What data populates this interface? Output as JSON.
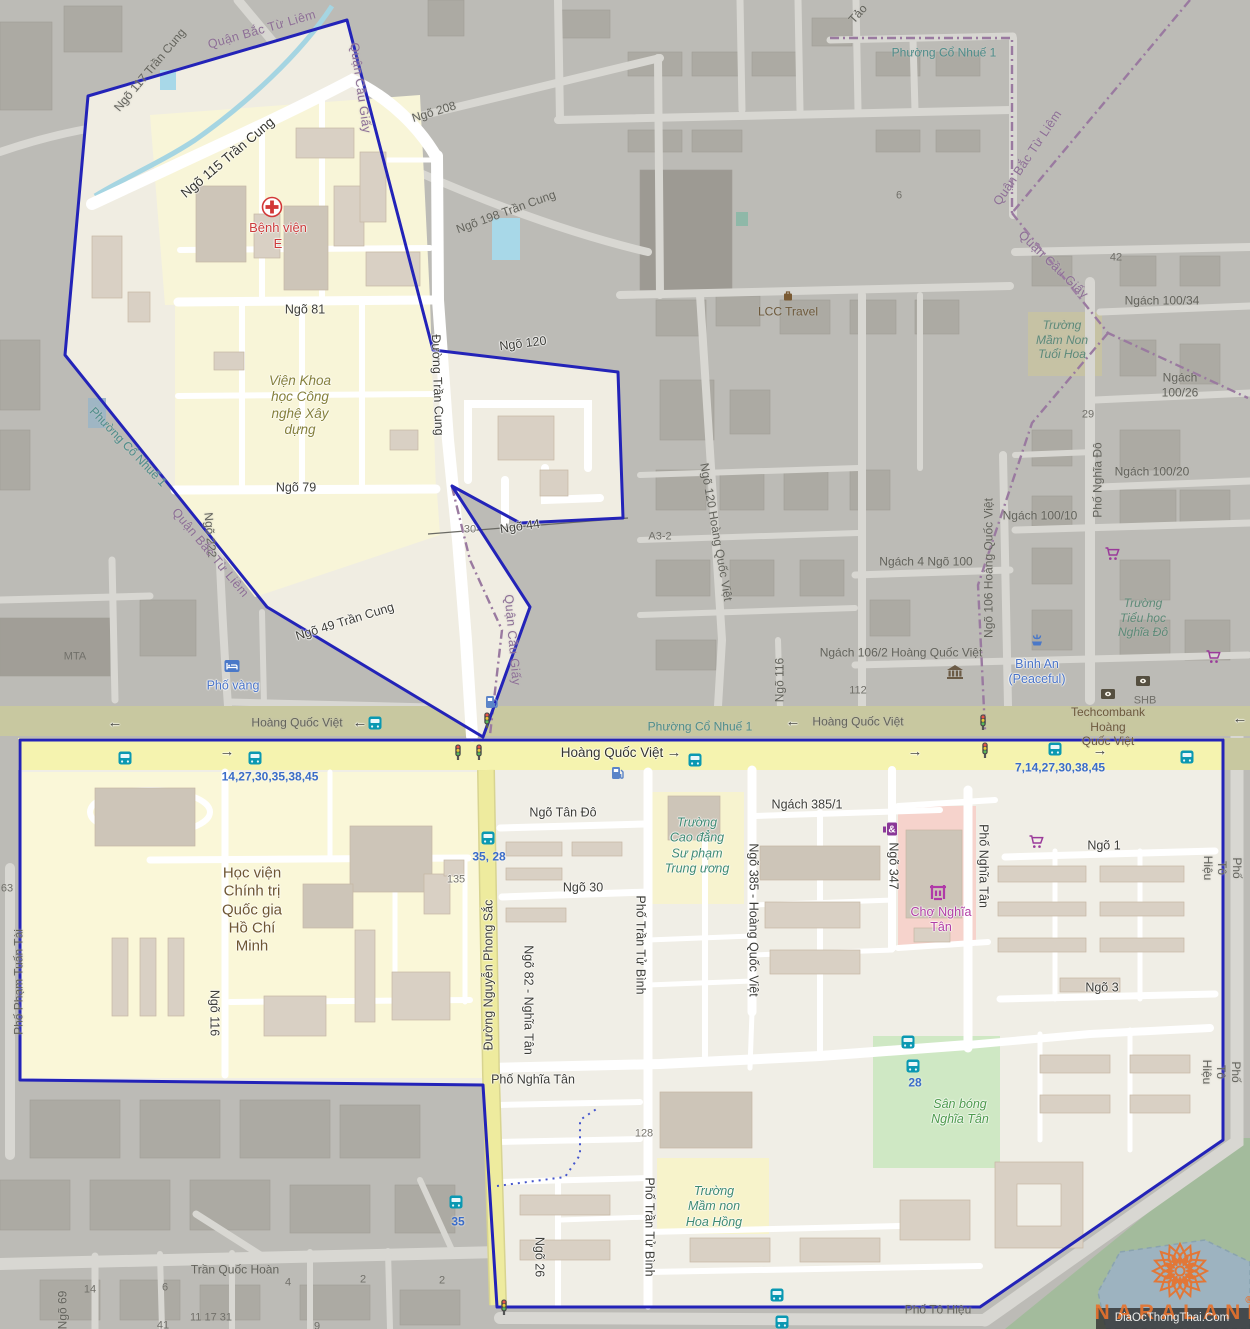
{
  "page": {
    "width": 1250,
    "height": 1329
  },
  "watermark": {
    "brand": "NARALAND",
    "reg": "®",
    "attribution": "DiaOcThongThai.Com"
  },
  "colors": {
    "boundary": "#2323b8",
    "admin_boundary": "#9a7aa0",
    "residential": "#faf7d8",
    "main_road": "#f5f3af",
    "dim_base": "#bcbbb6",
    "bus_badge": "#0a98b2",
    "route_text": "#3a6cc8",
    "watermark_orange": "#e8722c"
  },
  "labels": [
    {
      "id": "ngo-117",
      "text": "Ngõ 117 Trần Cung",
      "x": 150,
      "y": 70,
      "rot": -50,
      "cls": "rd-dim"
    },
    {
      "id": "quan-bac-tu-liem-top",
      "text": "Quận Bắc Từ Liêm",
      "x": 262,
      "y": 30,
      "rot": -16,
      "cls": "adm"
    },
    {
      "id": "quan-cau-giay-top",
      "text": "Quận Cầu Giấy",
      "x": 360,
      "y": 88,
      "rot": 82,
      "cls": "adm"
    },
    {
      "id": "ngo-115-tran-cung",
      "text": "Ngõ 115 Trần Cung",
      "x": 228,
      "y": 158,
      "rot": -40,
      "cls": "rd-big"
    },
    {
      "id": "benh-vien-e",
      "text": "Bệnh viện\nE",
      "x": 278,
      "y": 236,
      "rot": 0,
      "cls": "red"
    },
    {
      "id": "ngo-208",
      "text": "Ngõ 208",
      "x": 434,
      "y": 112,
      "rot": -17,
      "cls": "rd-dim"
    },
    {
      "id": "ngo-198-tran-cung",
      "text": "Ngõ 198 Trần Cung",
      "x": 506,
      "y": 212,
      "rot": -20,
      "cls": "rd-dim"
    },
    {
      "id": "phuong-co-nhue-1-top",
      "text": "Phường Cổ Nhuế 1",
      "x": 944,
      "y": 53,
      "rot": 0,
      "cls": "plc"
    },
    {
      "id": "tao",
      "text": "Tảo",
      "x": 858,
      "y": 14,
      "rot": -48,
      "cls": "rd-dim"
    },
    {
      "id": "quan-bac-tu-liem-right",
      "text": "Quận Bắc Từ Liêm",
      "x": 1028,
      "y": 158,
      "rot": -56,
      "cls": "adm"
    },
    {
      "id": "quan-cau-giay-right",
      "text": "Quận Cầu Giấy",
      "x": 1053,
      "y": 265,
      "rot": 44,
      "cls": "adm"
    },
    {
      "id": "num-6",
      "text": "6",
      "x": 899,
      "y": 196,
      "rot": 0,
      "cls": "num-dim"
    },
    {
      "id": "num-42",
      "text": "42",
      "x": 1116,
      "y": 258,
      "rot": 0,
      "cls": "num-dim"
    },
    {
      "id": "ngach-100-34",
      "text": "Ngách 100/34",
      "x": 1162,
      "y": 301,
      "rot": 0,
      "cls": "rd-dim"
    },
    {
      "id": "truong-mam-non-tuoi-hoa",
      "text": "Trường\nMầm Non\nTuổi Hoa",
      "x": 1062,
      "y": 340,
      "rot": 0,
      "cls": "sch-dim"
    },
    {
      "id": "ngach-100-26",
      "text": "Ngách 100/26",
      "x": 1180,
      "y": 385,
      "rot": 0,
      "cls": "rd-dim"
    },
    {
      "id": "num-29",
      "text": "29",
      "x": 1088,
      "y": 415,
      "rot": 0,
      "cls": "num-dim"
    },
    {
      "id": "pho-nghia-do",
      "text": "Phố Nghĩa Đô",
      "x": 1098,
      "y": 480,
      "rot": -90,
      "cls": "rd-dim"
    },
    {
      "id": "ngach-100-20",
      "text": "Ngách 100/20",
      "x": 1152,
      "y": 472,
      "rot": 0,
      "cls": "rd-dim"
    },
    {
      "id": "ngach-100-10",
      "text": "Ngách 100/10",
      "x": 1040,
      "y": 516,
      "rot": 0,
      "cls": "rd-dim"
    },
    {
      "id": "ngach-4-ngo-100",
      "text": "Ngách 4 Ngõ 100",
      "x": 926,
      "y": 562,
      "rot": 0,
      "cls": "rd-dim"
    },
    {
      "id": "ngo-106-hqv",
      "text": "Ngõ 106 Hoàng Quốc Việt",
      "x": 989,
      "y": 568,
      "rot": -90,
      "cls": "rd-dim"
    },
    {
      "id": "truong-tieu-hoc-nghia-do",
      "text": "Trường\nTiểu học\nNghĩa Đô",
      "x": 1143,
      "y": 618,
      "rot": 0,
      "cls": "sch-dim"
    },
    {
      "id": "lcc-travel",
      "text": "LCC Travel",
      "x": 788,
      "y": 312,
      "rot": 0,
      "cls": "brown-dim"
    },
    {
      "id": "ngo-120",
      "text": "Ngõ 120",
      "x": 523,
      "y": 344,
      "rot": -7,
      "cls": "rd"
    },
    {
      "id": "ngo-81",
      "text": "Ngõ 81",
      "x": 305,
      "y": 310,
      "rot": 0,
      "cls": "rd"
    },
    {
      "id": "vien-khoa-hoc",
      "text": "Viện Khoa\nhọc Công\nnghệ Xây\ndựng",
      "x": 300,
      "y": 406,
      "rot": 0,
      "cls": "olive"
    },
    {
      "id": "ngo-79",
      "text": "Ngõ 79",
      "x": 296,
      "y": 488,
      "rot": 0,
      "cls": "rd"
    },
    {
      "id": "duong-tran-cung",
      "text": "Đường Trần Cung",
      "x": 437,
      "y": 385,
      "rot": 88,
      "cls": "rd"
    },
    {
      "id": "a3-2",
      "text": "A3-2",
      "x": 660,
      "y": 537,
      "rot": 0,
      "cls": "num-dim"
    },
    {
      "id": "ngo-120-hqv",
      "text": "Ngõ 120 Hoàng Quốc Việt",
      "x": 716,
      "y": 532,
      "rot": 80,
      "cls": "rd-dim"
    },
    {
      "id": "ngo-44",
      "text": "Ngõ 44",
      "x": 520,
      "y": 527,
      "rot": -8,
      "cls": "rd"
    },
    {
      "id": "num-30-track",
      "text": "30",
      "x": 470,
      "y": 530,
      "rot": 0,
      "cls": "num"
    },
    {
      "id": "ngach-106-2",
      "text": "Ngách 106/2 Hoàng Quốc Việt",
      "x": 901,
      "y": 653,
      "rot": 0,
      "cls": "rd-dim"
    },
    {
      "id": "num-112",
      "text": "112",
      "x": 858,
      "y": 691,
      "rot": 0,
      "cls": "num-dim"
    },
    {
      "id": "ngo-116-dim",
      "text": "Ngõ 116",
      "x": 780,
      "y": 680,
      "rot": -90,
      "cls": "rd-dim"
    },
    {
      "id": "binh-an",
      "text": "Bình An\n(Peaceful)",
      "x": 1037,
      "y": 672,
      "rot": 0,
      "cls": "blue"
    },
    {
      "id": "shb",
      "text": "SHB",
      "x": 1145,
      "y": 701,
      "rot": 0,
      "cls": "num-dim"
    },
    {
      "id": "techcombank",
      "text": "Techcombank\nHoàng\nQuốc Việt",
      "x": 1108,
      "y": 727,
      "rot": 0,
      "cls": "brown-dim"
    },
    {
      "id": "mta",
      "text": "MTA",
      "x": 75,
      "y": 657,
      "rot": 0,
      "cls": "num-dim"
    },
    {
      "id": "ngo-222",
      "text": "Ngõ 222",
      "x": 210,
      "y": 535,
      "rot": 85,
      "cls": "rd-dim"
    },
    {
      "id": "phuong-co-nhue-1-left",
      "text": "Phường Cổ Nhuế 1",
      "x": 128,
      "y": 447,
      "rot": 46,
      "cls": "plc"
    },
    {
      "id": "quan-bac-tu-liem-left",
      "text": "Quận Bắc Từ Liêm",
      "x": 210,
      "y": 553,
      "rot": 50,
      "cls": "adm"
    },
    {
      "id": "ngo-49-tran-cung",
      "text": "Ngõ 49 Trần Cung",
      "x": 345,
      "y": 622,
      "rot": -17,
      "cls": "rd"
    },
    {
      "id": "pho-vang",
      "text": "Phố vàng",
      "x": 233,
      "y": 686,
      "rot": 0,
      "cls": "blue"
    },
    {
      "id": "hqv-dim-left",
      "text": "Hoàng Quốc Việt",
      "x": 297,
      "y": 723,
      "rot": 0,
      "cls": "rd-dim"
    },
    {
      "id": "arrow-dim-1",
      "text": "←",
      "x": 115,
      "y": 723,
      "rot": 0,
      "cls": "arr"
    },
    {
      "id": "arrow-dim-2",
      "text": "←",
      "x": 360,
      "y": 723,
      "rot": 0,
      "cls": "arr"
    },
    {
      "id": "phuong-co-nhue-1-road",
      "text": "Phường Cổ Nhuế 1",
      "x": 700,
      "y": 727,
      "rot": 0,
      "cls": "plc"
    },
    {
      "id": "arrow-dim-3",
      "text": "←",
      "x": 793,
      "y": 722,
      "rot": 0,
      "cls": "arr"
    },
    {
      "id": "hqv-dim-right",
      "text": "Hoàng Quốc Việt",
      "x": 858,
      "y": 722,
      "rot": 0,
      "cls": "rd-dim"
    },
    {
      "id": "arrow-dim-4",
      "text": "←",
      "x": 1240,
      "y": 719,
      "rot": 0,
      "cls": "arr"
    },
    {
      "id": "hqv-bright",
      "text": "Hoàng Quốc Việt",
      "x": 612,
      "y": 753,
      "rot": 0,
      "cls": "rd-big"
    },
    {
      "id": "arrow-br-1",
      "text": "→",
      "x": 674,
      "y": 753,
      "rot": 0,
      "cls": "arr"
    },
    {
      "id": "arrow-br-2",
      "text": "→",
      "x": 227,
      "y": 752,
      "rot": 0,
      "cls": "arr"
    },
    {
      "id": "arrow-br-3",
      "text": "→",
      "x": 915,
      "y": 752,
      "rot": 0,
      "cls": "arr"
    },
    {
      "id": "arrow-br-4",
      "text": "→",
      "x": 1100,
      "y": 751,
      "rot": 0,
      "cls": "arr"
    },
    {
      "id": "bus-routes-left",
      "text": "14,27,30,35,38,45",
      "x": 270,
      "y": 777,
      "rot": 0,
      "cls": "bus"
    },
    {
      "id": "bus-routes-right",
      "text": "7,14,27,30,38,45",
      "x": 1060,
      "y": 768,
      "rot": 0,
      "cls": "bus"
    },
    {
      "id": "ngo-tan-do",
      "text": "Ngõ Tân Đô",
      "x": 563,
      "y": 813,
      "rot": 0,
      "cls": "rd"
    },
    {
      "id": "ngach-385-1",
      "text": "Ngách 385/1",
      "x": 807,
      "y": 805,
      "rot": 0,
      "cls": "rd"
    },
    {
      "id": "truong-cao-dang",
      "text": "Trường\nCao đẳng\nSư phạm\nTrung ương",
      "x": 697,
      "y": 846,
      "rot": 0,
      "cls": "sch"
    },
    {
      "id": "ngo-385-hqv",
      "text": "Ngõ 385 - Hoàng Quốc Việt",
      "x": 753,
      "y": 920,
      "rot": 90,
      "cls": "rd"
    },
    {
      "id": "ngo-347",
      "text": "Ngõ 347",
      "x": 893,
      "y": 866,
      "rot": 90,
      "cls": "rd"
    },
    {
      "id": "pho-nghia-tan-vert",
      "text": "Phố Nghĩa Tân",
      "x": 983,
      "y": 866,
      "rot": 90,
      "cls": "rd"
    },
    {
      "id": "cho-nghia-tan",
      "text": "Chợ Nghĩa\nTân",
      "x": 941,
      "y": 920,
      "rot": 0,
      "cls": "mag"
    },
    {
      "id": "ngo-1",
      "text": "Ngõ 1",
      "x": 1104,
      "y": 846,
      "rot": 0,
      "cls": "rd"
    },
    {
      "id": "pho-to-hieu-1",
      "text": "Phố Tô Hiệu",
      "x": 1222,
      "y": 868,
      "rot": 90,
      "cls": "rd-dim"
    },
    {
      "id": "ngo-3",
      "text": "Ngõ 3",
      "x": 1102,
      "y": 988,
      "rot": 0,
      "cls": "rd"
    },
    {
      "id": "hoc-vien",
      "text": "Học viện\nChính trị\nQuốc gia\nHồ Chí\nMinh",
      "x": 252,
      "y": 910,
      "rot": 0,
      "cls": "brown-big"
    },
    {
      "id": "num-135",
      "text": "135",
      "x": 456,
      "y": 880,
      "rot": 0,
      "cls": "num"
    },
    {
      "id": "bus-35-28",
      "text": "35, 28",
      "x": 489,
      "y": 857,
      "rot": 0,
      "cls": "bus"
    },
    {
      "id": "duong-nguyen-phong-sac",
      "text": "Đường Nguyễn Phong Sắc",
      "x": 489,
      "y": 975,
      "rot": -90,
      "cls": "rd"
    },
    {
      "id": "ngo-82-nghia-tan",
      "text": "Ngõ 82 - Nghĩa Tân",
      "x": 528,
      "y": 1000,
      "rot": 90,
      "cls": "rd"
    },
    {
      "id": "ngo-116-bright",
      "text": "Ngõ 116",
      "x": 214,
      "y": 1013,
      "rot": 90,
      "cls": "rd"
    },
    {
      "id": "pho-pham-tuan-tai",
      "text": "Phố Phạm Tuấn Tài",
      "x": 19,
      "y": 982,
      "rot": -90,
      "cls": "rd-dim"
    },
    {
      "id": "num-63",
      "text": "63",
      "x": 7,
      "y": 889,
      "rot": 0,
      "cls": "num-dim"
    },
    {
      "id": "ngo-30",
      "text": "Ngõ 30",
      "x": 583,
      "y": 888,
      "rot": 0,
      "cls": "rd"
    },
    {
      "id": "quan-cau-giay-mid",
      "text": "Quận Cầu Giấy",
      "x": 512,
      "y": 640,
      "rot": 85,
      "cls": "adm"
    },
    {
      "id": "pho-nghia-tan-horiz",
      "text": "Phố Nghĩa Tân",
      "x": 533,
      "y": 1080,
      "rot": 0,
      "cls": "rd"
    },
    {
      "id": "num-128",
      "text": "128",
      "x": 644,
      "y": 1134,
      "rot": 0,
      "cls": "num"
    },
    {
      "id": "pho-tran-tu-binh-1",
      "text": "Phố Trần Tử Bình",
      "x": 640,
      "y": 945,
      "rot": 90,
      "cls": "rd"
    },
    {
      "id": "pho-tran-tu-binh-2",
      "text": "Phố Trần Tử Bình",
      "x": 649,
      "y": 1227,
      "rot": 90,
      "cls": "rd"
    },
    {
      "id": "truong-mam-non-hoa-hong",
      "text": "Trường\nMầm non\nHoa Hồng",
      "x": 714,
      "y": 1207,
      "rot": 0,
      "cls": "sch"
    },
    {
      "id": "san-bong-nghia-tan",
      "text": "Sân bóng\nNghĩa Tân",
      "x": 960,
      "y": 1112,
      "rot": 0,
      "cls": "grn"
    },
    {
      "id": "bus-28",
      "text": "28",
      "x": 915,
      "y": 1083,
      "rot": 0,
      "cls": "bus"
    },
    {
      "id": "ngo-26",
      "text": "Ngõ 26",
      "x": 539,
      "y": 1257,
      "rot": 90,
      "cls": "rd"
    },
    {
      "id": "bus-35",
      "text": "35",
      "x": 458,
      "y": 1222,
      "rot": 0,
      "cls": "bus"
    },
    {
      "id": "tran-quoc-hoan",
      "text": "Trần Quốc Hoàn",
      "x": 235,
      "y": 1270,
      "rot": 0,
      "cls": "rd-dim"
    },
    {
      "id": "num-14",
      "text": "14",
      "x": 90,
      "y": 1290,
      "rot": 0,
      "cls": "num-dim"
    },
    {
      "id": "num-6b",
      "text": "6",
      "x": 165,
      "y": 1288,
      "rot": 0,
      "cls": "num-dim"
    },
    {
      "id": "num-4",
      "text": "4",
      "x": 288,
      "y": 1283,
      "rot": 0,
      "cls": "num-dim"
    },
    {
      "id": "num-2a",
      "text": "2",
      "x": 363,
      "y": 1280,
      "rot": 0,
      "cls": "num-dim"
    },
    {
      "id": "num-2b",
      "text": "2",
      "x": 442,
      "y": 1281,
      "rot": 0,
      "cls": "num-dim"
    },
    {
      "id": "num-11-17-31",
      "text": "11  17  31",
      "x": 211,
      "y": 1318,
      "rot": 0,
      "cls": "num-dim"
    },
    {
      "id": "num-41",
      "text": "41",
      "x": 163,
      "y": 1326,
      "rot": 0,
      "cls": "num-dim"
    },
    {
      "id": "num-9",
      "text": "9",
      "x": 317,
      "y": 1327,
      "rot": 0,
      "cls": "num-dim"
    },
    {
      "id": "ngo-69",
      "text": "Ngõ 69",
      "x": 63,
      "y": 1310,
      "rot": -90,
      "cls": "rd-dim"
    },
    {
      "id": "pho-to-hieu-2",
      "text": "Phố Tô Hiệu",
      "x": 1221,
      "y": 1072,
      "rot": 90,
      "cls": "rd-dim"
    },
    {
      "id": "pho-to-hieu-3",
      "text": "Phố Tô Hiệu",
      "x": 938,
      "y": 1310,
      "rot": 0,
      "cls": "rd-dim"
    }
  ],
  "icons": [
    {
      "type": "hospital",
      "x": 272,
      "y": 207
    },
    {
      "type": "bus",
      "x": 375,
      "y": 723
    },
    {
      "type": "bus",
      "x": 125,
      "y": 758
    },
    {
      "type": "bus",
      "x": 255,
      "y": 758
    },
    {
      "type": "bus",
      "x": 695,
      "y": 760
    },
    {
      "type": "bus",
      "x": 1055,
      "y": 749
    },
    {
      "type": "bus",
      "x": 1187,
      "y": 757
    },
    {
      "type": "bus",
      "x": 488,
      "y": 838
    },
    {
      "type": "bus",
      "x": 456,
      "y": 1202
    },
    {
      "type": "bus",
      "x": 908,
      "y": 1042
    },
    {
      "type": "bus",
      "x": 913,
      "y": 1066
    },
    {
      "type": "bus",
      "x": 777,
      "y": 1295
    },
    {
      "type": "bus",
      "x": 782,
      "y": 1322
    },
    {
      "type": "fuel",
      "x": 492,
      "y": 702
    },
    {
      "type": "fuel",
      "x": 618,
      "y": 773
    },
    {
      "type": "traffic-light",
      "x": 458,
      "y": 752
    },
    {
      "type": "traffic-light",
      "x": 479,
      "y": 752
    },
    {
      "type": "traffic-light",
      "x": 487,
      "y": 720
    },
    {
      "type": "traffic-light",
      "x": 983,
      "y": 722
    },
    {
      "type": "traffic-light",
      "x": 985,
      "y": 750
    },
    {
      "type": "traffic-light",
      "x": 504,
      "y": 1307
    },
    {
      "type": "museum",
      "x": 955,
      "y": 672
    },
    {
      "type": "bank",
      "x": 1108,
      "y": 694
    },
    {
      "type": "bank",
      "x": 1143,
      "y": 681
    },
    {
      "type": "shopping-cart",
      "x": 1112,
      "y": 554
    },
    {
      "type": "shopping-cart",
      "x": 1213,
      "y": 657
    },
    {
      "type": "shopping-cart",
      "x": 1036,
      "y": 842
    },
    {
      "type": "pharmacy",
      "x": 890,
      "y": 829
    },
    {
      "type": "market",
      "x": 938,
      "y": 892
    },
    {
      "type": "hotel",
      "x": 232,
      "y": 666
    },
    {
      "type": "fountain",
      "x": 1037,
      "y": 640
    },
    {
      "type": "luggage",
      "x": 788,
      "y": 296
    },
    {
      "type": "logo-flower",
      "x": 1180,
      "y": 1271
    }
  ]
}
